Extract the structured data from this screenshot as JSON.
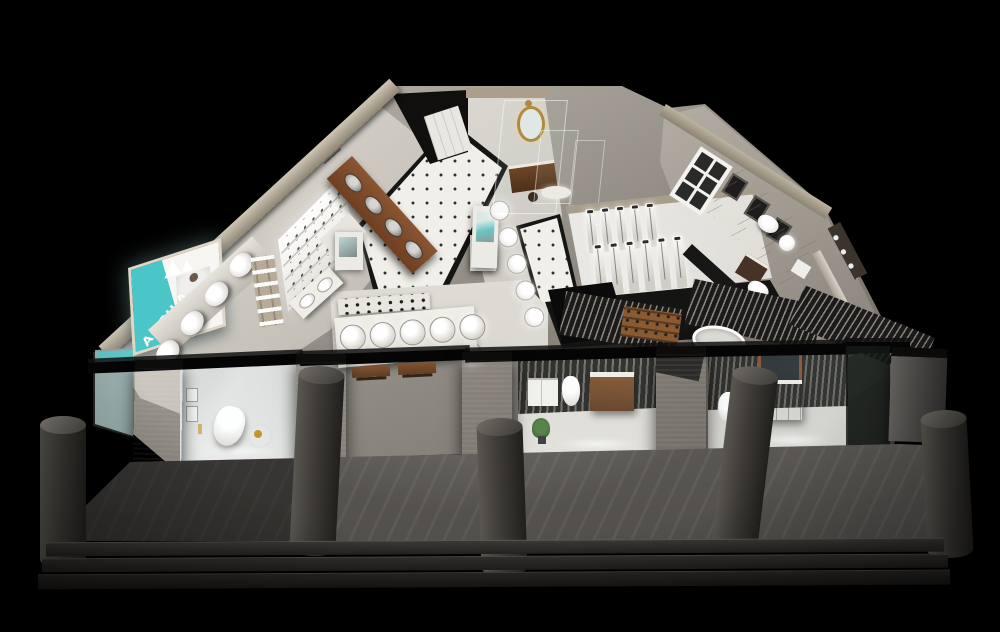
{
  "scene": {
    "kind": "3d-architectural-render",
    "subject": "aerial cutaway render of a bathroom sanitary-ware showroom at night",
    "background_color": "#000000"
  },
  "brand": {
    "billboard_text": "AGGILA",
    "billboard_bg_color": "#4ac6c8",
    "billboard_text_color": "#ffffff"
  },
  "palette": {
    "teal": "#4ac6c8",
    "wallBeige": "#b5ab9a",
    "wallBeigeDark": "#8d8373",
    "floorLight": "#ece9e2",
    "tile": "#f1efe9",
    "tileDot": "#2f2f2d",
    "aisleDark": "#161614",
    "wood": "#7a4a28",
    "woodDark": "#4e2c16",
    "porcelain": "#f0eeea",
    "pier": "#4f4d4a",
    "column": "#3c3a37",
    "walkway": "#6b6864",
    "step": "#2a2826",
    "beam": "#070707",
    "marble": "#d6d0c7",
    "gold": "#b08a3e",
    "plant": "#4a7a3a",
    "glassTint": "#aebfbd",
    "slatLight": "#8a8680",
    "slatDark": "#1c1b1a"
  },
  "front": {
    "steps": 3,
    "columns": 5,
    "piers": 4
  },
  "displays": {
    "leftWallToilets": 4,
    "woodCounterSinks": 4,
    "shelfRows": 5,
    "basinCounterBowls": 2,
    "counterBasins": 5,
    "basinPedestals": 5,
    "showerUnitsBack": 5,
    "showerUnitsFront": 6,
    "windowPanes": 6,
    "marbleStalls": 4
  },
  "vignettes": [
    {
      "name": "toilet-accessories-room"
    },
    {
      "name": "modern-bathroom-room"
    },
    {
      "name": "classic-wood-bathroom-room"
    }
  ]
}
